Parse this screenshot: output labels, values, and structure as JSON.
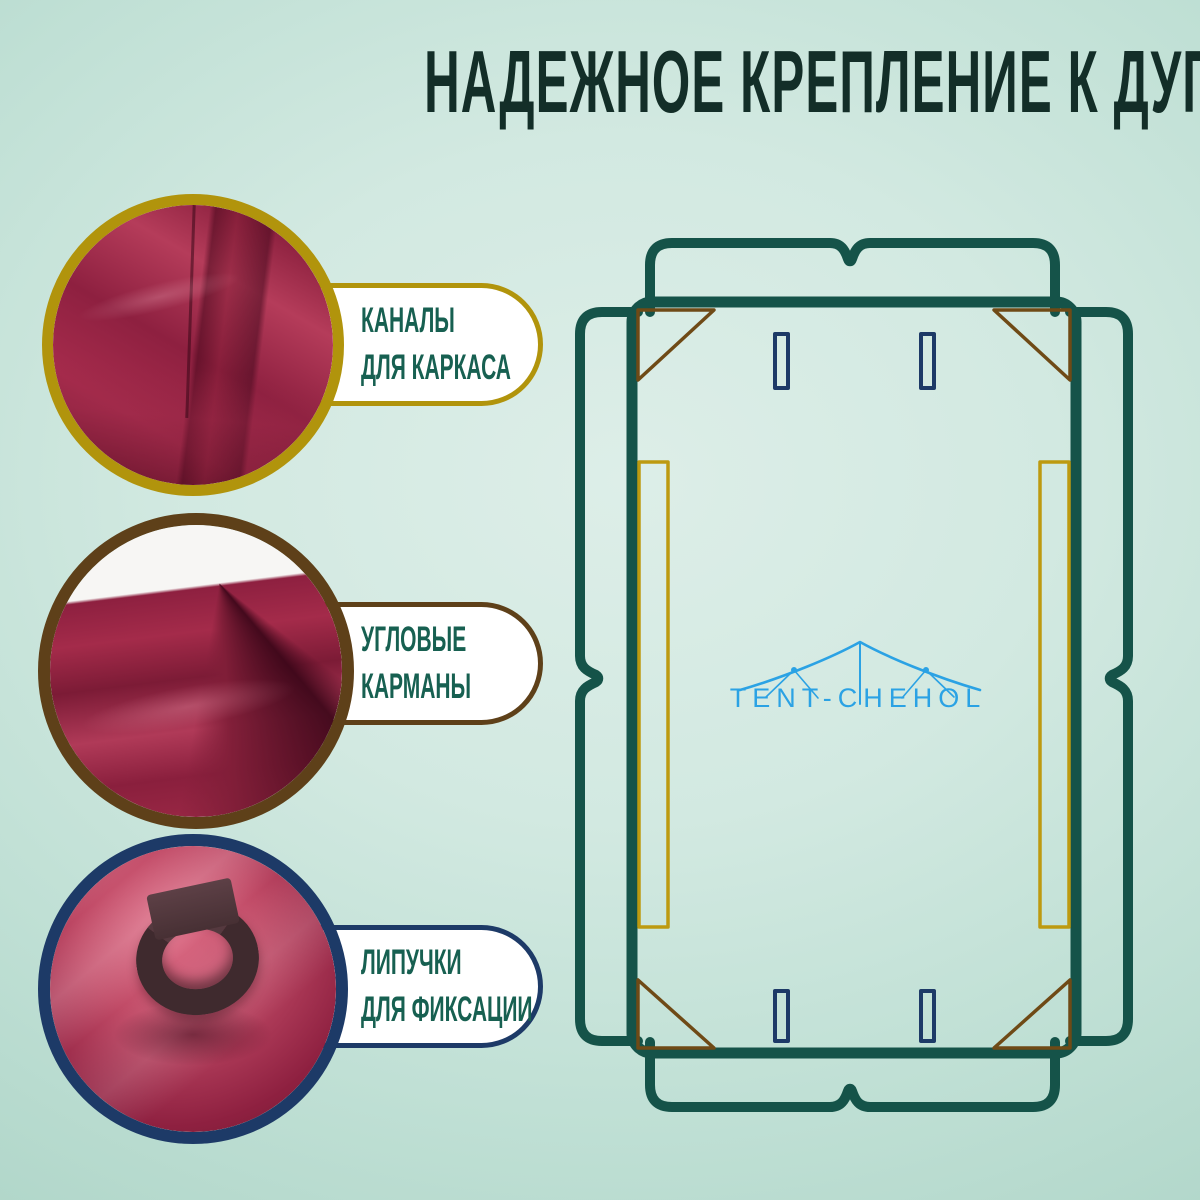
{
  "title": "НАДЕЖНОЕ КРЕПЛЕНИЕ К ДУГАМ КРЫШИ",
  "features": [
    {
      "id": "frame-channels",
      "lines": [
        "КАНАЛЫ",
        "ДЛЯ КАРКАСА"
      ],
      "accent_color": "#b1940c",
      "photo_alt": "burgundy tarp fabric with sewn channel for the frame"
    },
    {
      "id": "corner-pockets",
      "lines": [
        "УГЛОВЫЕ",
        "КАРМАНЫ"
      ],
      "accent_color": "#5e4019",
      "photo_alt": "burgundy fabric corner pocket folded on white background"
    },
    {
      "id": "velcro-straps",
      "lines": [
        "ЛИПУЧКИ",
        "ДЛЯ ФИКСАЦИИ"
      ],
      "accent_color": "#1d3a67",
      "photo_alt": "dark velcro strap loop standing on red fabric"
    }
  ],
  "diagram": {
    "logo_text": "TENT-CHEHOL",
    "corner_pocket_count": 4,
    "frame_channel_count": 2,
    "strap_slot_count": 4,
    "flap_count": 4
  },
  "colors": {
    "background_mint": "#c8e4da",
    "title_green": "#132e28",
    "label_green": "#176051",
    "outline_green": "#155349",
    "accent_gold": "#b1940c",
    "accent_brown": "#5e4019",
    "accent_navy": "#1d3a67",
    "triangle_brown": "#6f4a16",
    "channel_gold": "#bd9a10",
    "logo_blue": "#2ba2e4",
    "fabric_burgundy": "#9c2846",
    "pill_white": "#ffffff"
  }
}
